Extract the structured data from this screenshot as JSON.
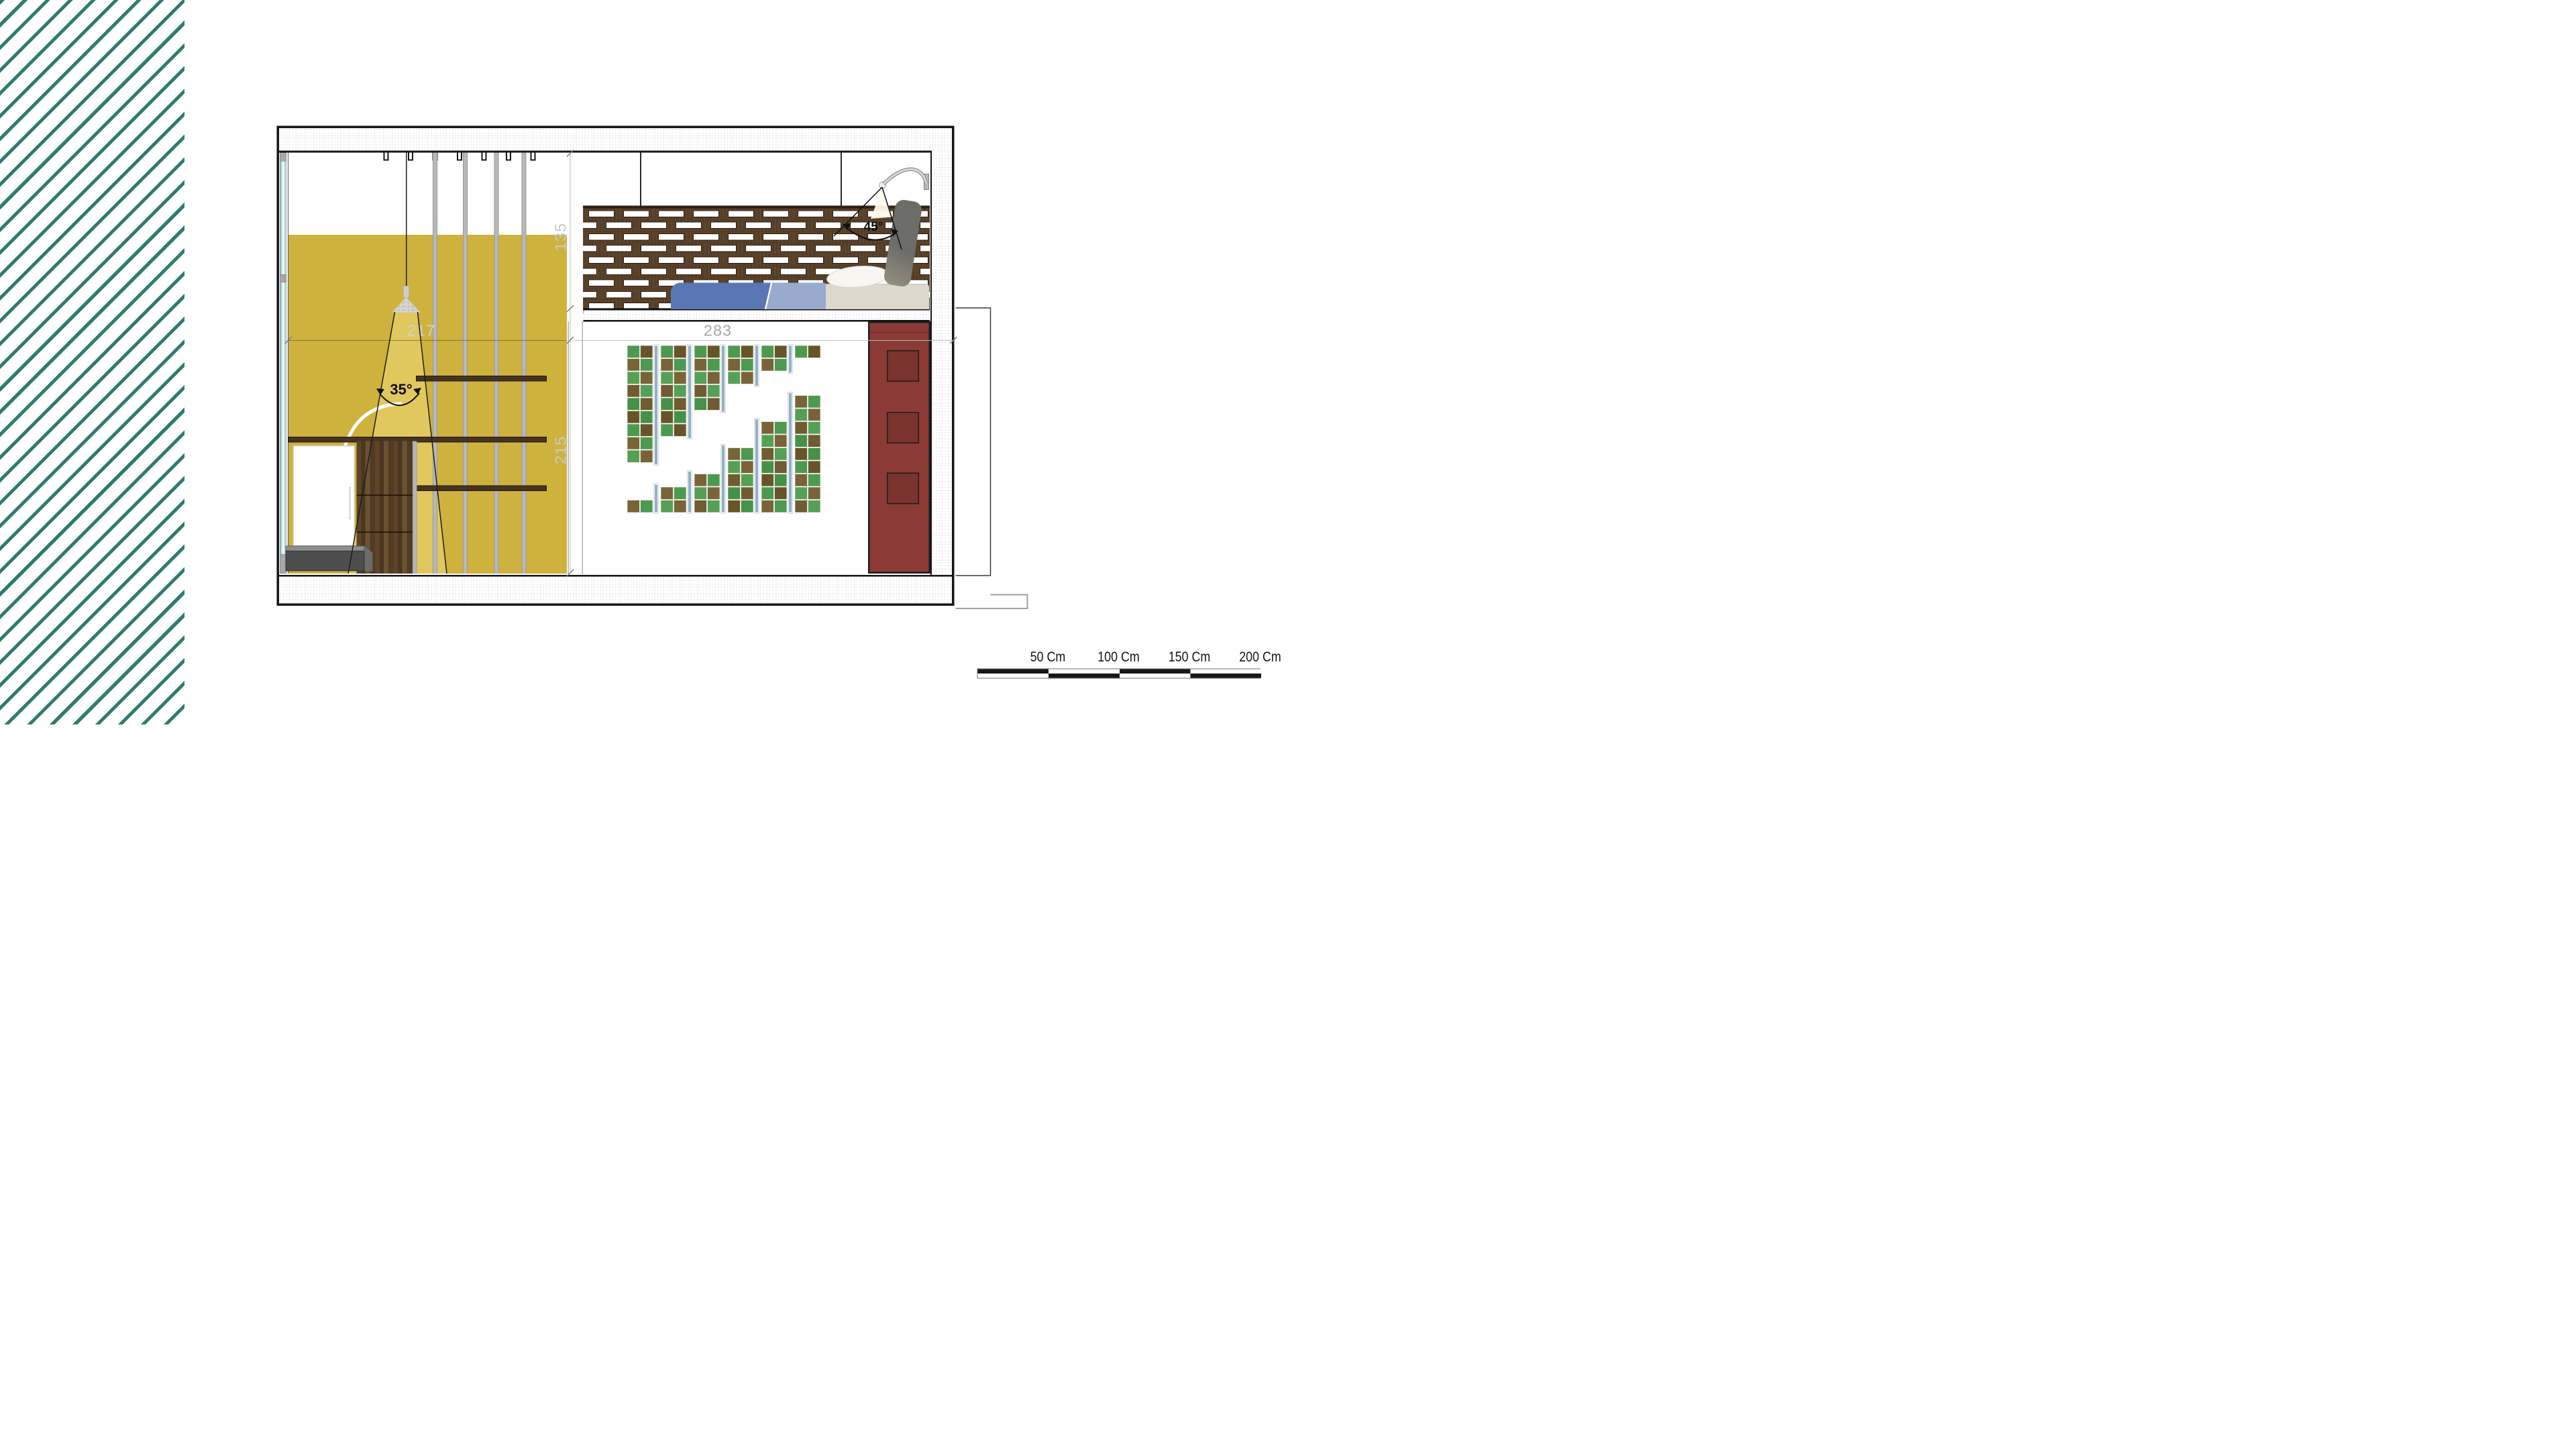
{
  "drawing": {
    "dimensions": {
      "d217": "217",
      "d283": "283",
      "d135": "135",
      "d215": "215"
    },
    "angles": {
      "pendant_cone": "35°",
      "bed_lamp": "45°"
    },
    "scale_bar": {
      "labels": [
        "50 Cm",
        "100 Cm",
        "150 Cm",
        "200 Cm"
      ],
      "segments": 4
    },
    "ceiling_hooks": 7,
    "wall_slats": 4,
    "shelves": 3,
    "lattice": {
      "rows": 9,
      "cols": 11
    },
    "checker": {
      "cols_per_block": 2,
      "group_a_rows": [
        9,
        7,
        5,
        3,
        2,
        1
      ],
      "group_b_rows": [
        1,
        2,
        3,
        5,
        7,
        9
      ]
    },
    "colors": {
      "stripe_teal": "#2e7b70",
      "wall_yellow": "#cfb23d",
      "light_cone": "#e5cd66",
      "panel_red": "#8b3a35",
      "panel_red_inset": "#7a332f",
      "blanket_blue": "#5b76b5",
      "blanket_light": "#98aacd",
      "mattress": "#dcd8cc",
      "tile_greens": [
        "#4d9950",
        "#459147",
        "#55a055"
      ],
      "tile_browns": [
        "#6f5c30",
        "#786437",
        "#675527"
      ],
      "tile_strip_blue": "#8fb2c4",
      "wood_dark": "#583f27",
      "scale_black": "#171717"
    }
  }
}
